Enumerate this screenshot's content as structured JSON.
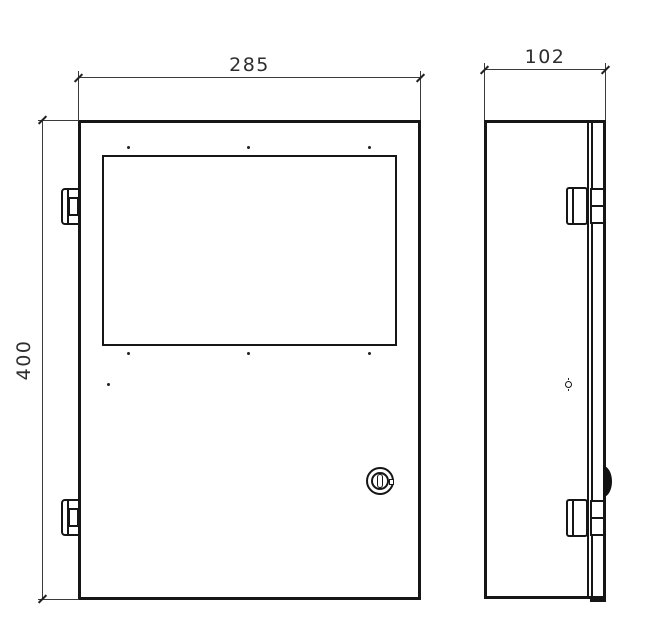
{
  "dimensions": {
    "front_width": "285",
    "front_height": "400",
    "side_depth": "102"
  },
  "colors": {
    "line": "#161616",
    "background": "#ffffff"
  }
}
